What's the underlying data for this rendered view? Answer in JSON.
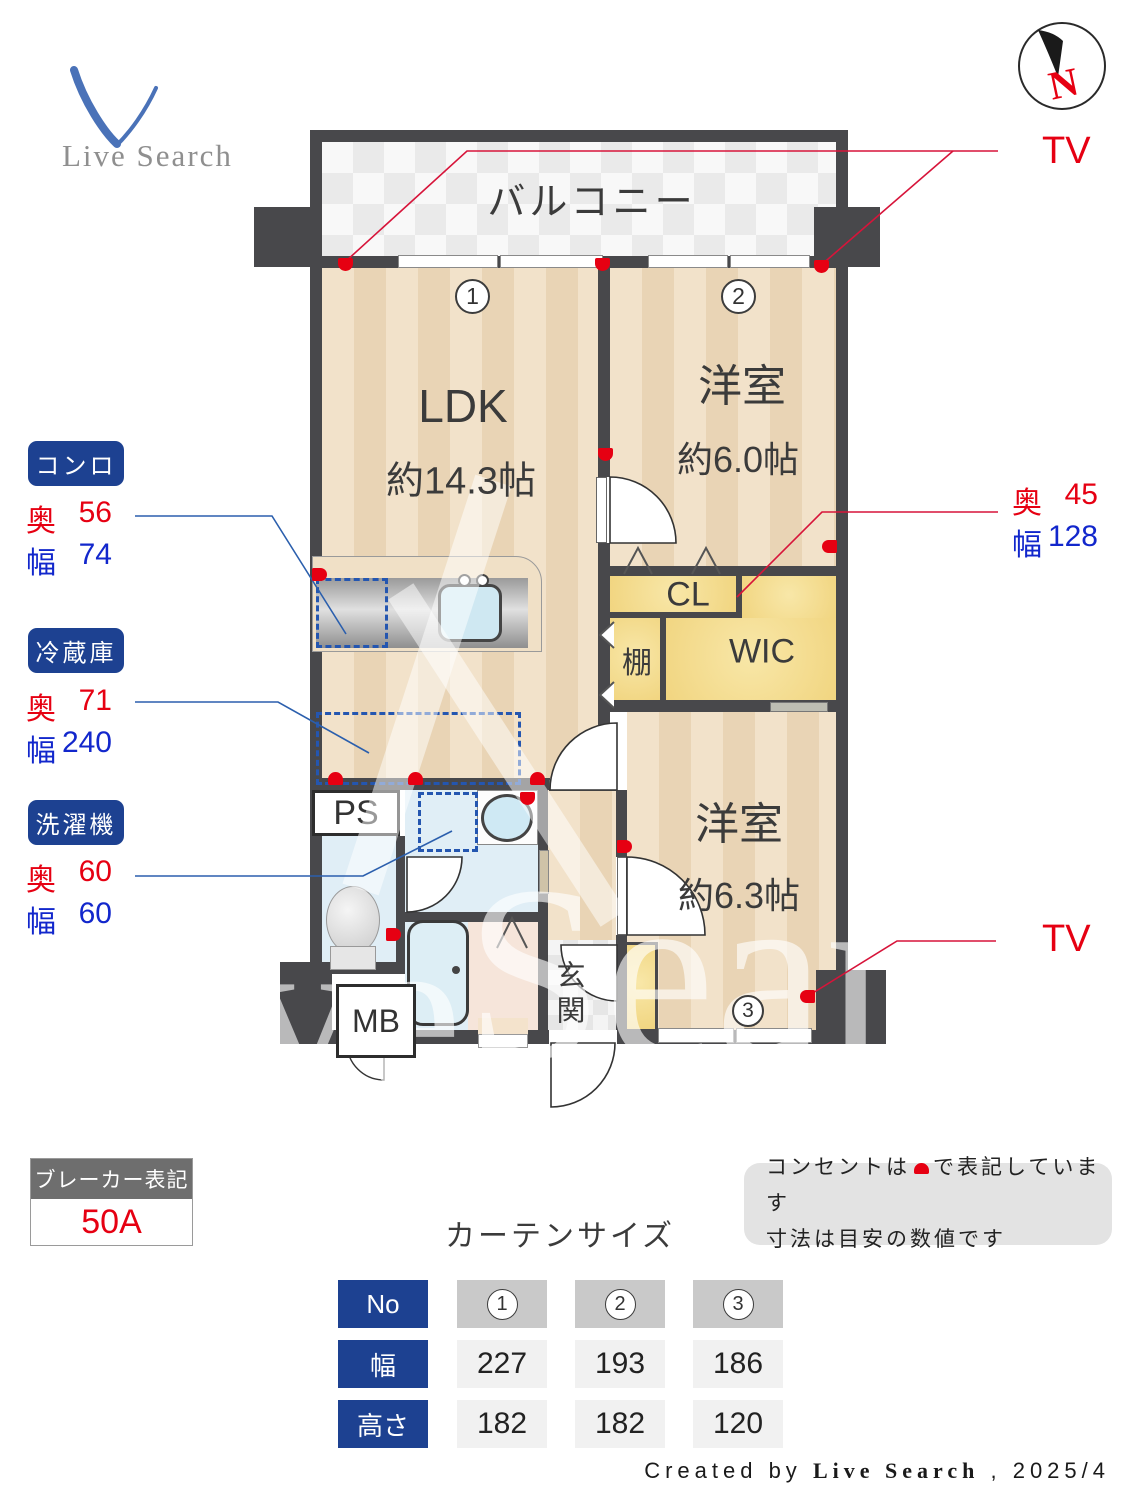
{
  "logo": {
    "brand": "Live Search"
  },
  "compass": {
    "north": "N"
  },
  "tv": {
    "top": "TV",
    "bottom": "TV"
  },
  "fixtures": {
    "stove": {
      "title": "コンロ",
      "depth_label": "奥",
      "depth_value": "56",
      "width_label": "幅",
      "width_value": "74"
    },
    "fridge": {
      "title": "冷蔵庫",
      "depth_label": "奥",
      "depth_value": "71",
      "width_label": "幅",
      "width_value": "240"
    },
    "washer": {
      "title": "洗濯機",
      "depth_label": "奥",
      "depth_value": "60",
      "width_label": "幅",
      "width_value": "60"
    },
    "closet": {
      "depth_label": "奥",
      "depth_value": "45",
      "width_label": "幅",
      "width_value": "128"
    }
  },
  "plan": {
    "balcony": "バルコニー",
    "ldk": {
      "no": "1",
      "name": "LDK",
      "size": "約14.3帖"
    },
    "room2": {
      "no": "2",
      "name": "洋室",
      "size": "約6.0帖"
    },
    "room3": {
      "no": "3",
      "name": "洋室",
      "size": "約6.3帖"
    },
    "cl": "CL",
    "wic": "WIC",
    "shelf": "棚",
    "ps": "PS",
    "mb": "MB",
    "entrance": "玄関"
  },
  "breaker": {
    "title": "ブレーカー表記",
    "value": "50A"
  },
  "curtain": {
    "title": "カーテンサイズ",
    "no_header": "No",
    "col_numbers": [
      "1",
      "2",
      "3"
    ],
    "rows": [
      {
        "header": "幅",
        "values": [
          "227",
          "193",
          "186"
        ]
      },
      {
        "header": "高さ",
        "values": [
          "182",
          "182",
          "120"
        ]
      }
    ]
  },
  "notes": {
    "line1_pre": "コンセントは",
    "line1_post": "で表記しています",
    "line2": "寸法は目安の数値です"
  },
  "credit": {
    "prefix": "Created by",
    "brand": "Live Search",
    "suffix": ", 2025/4"
  }
}
